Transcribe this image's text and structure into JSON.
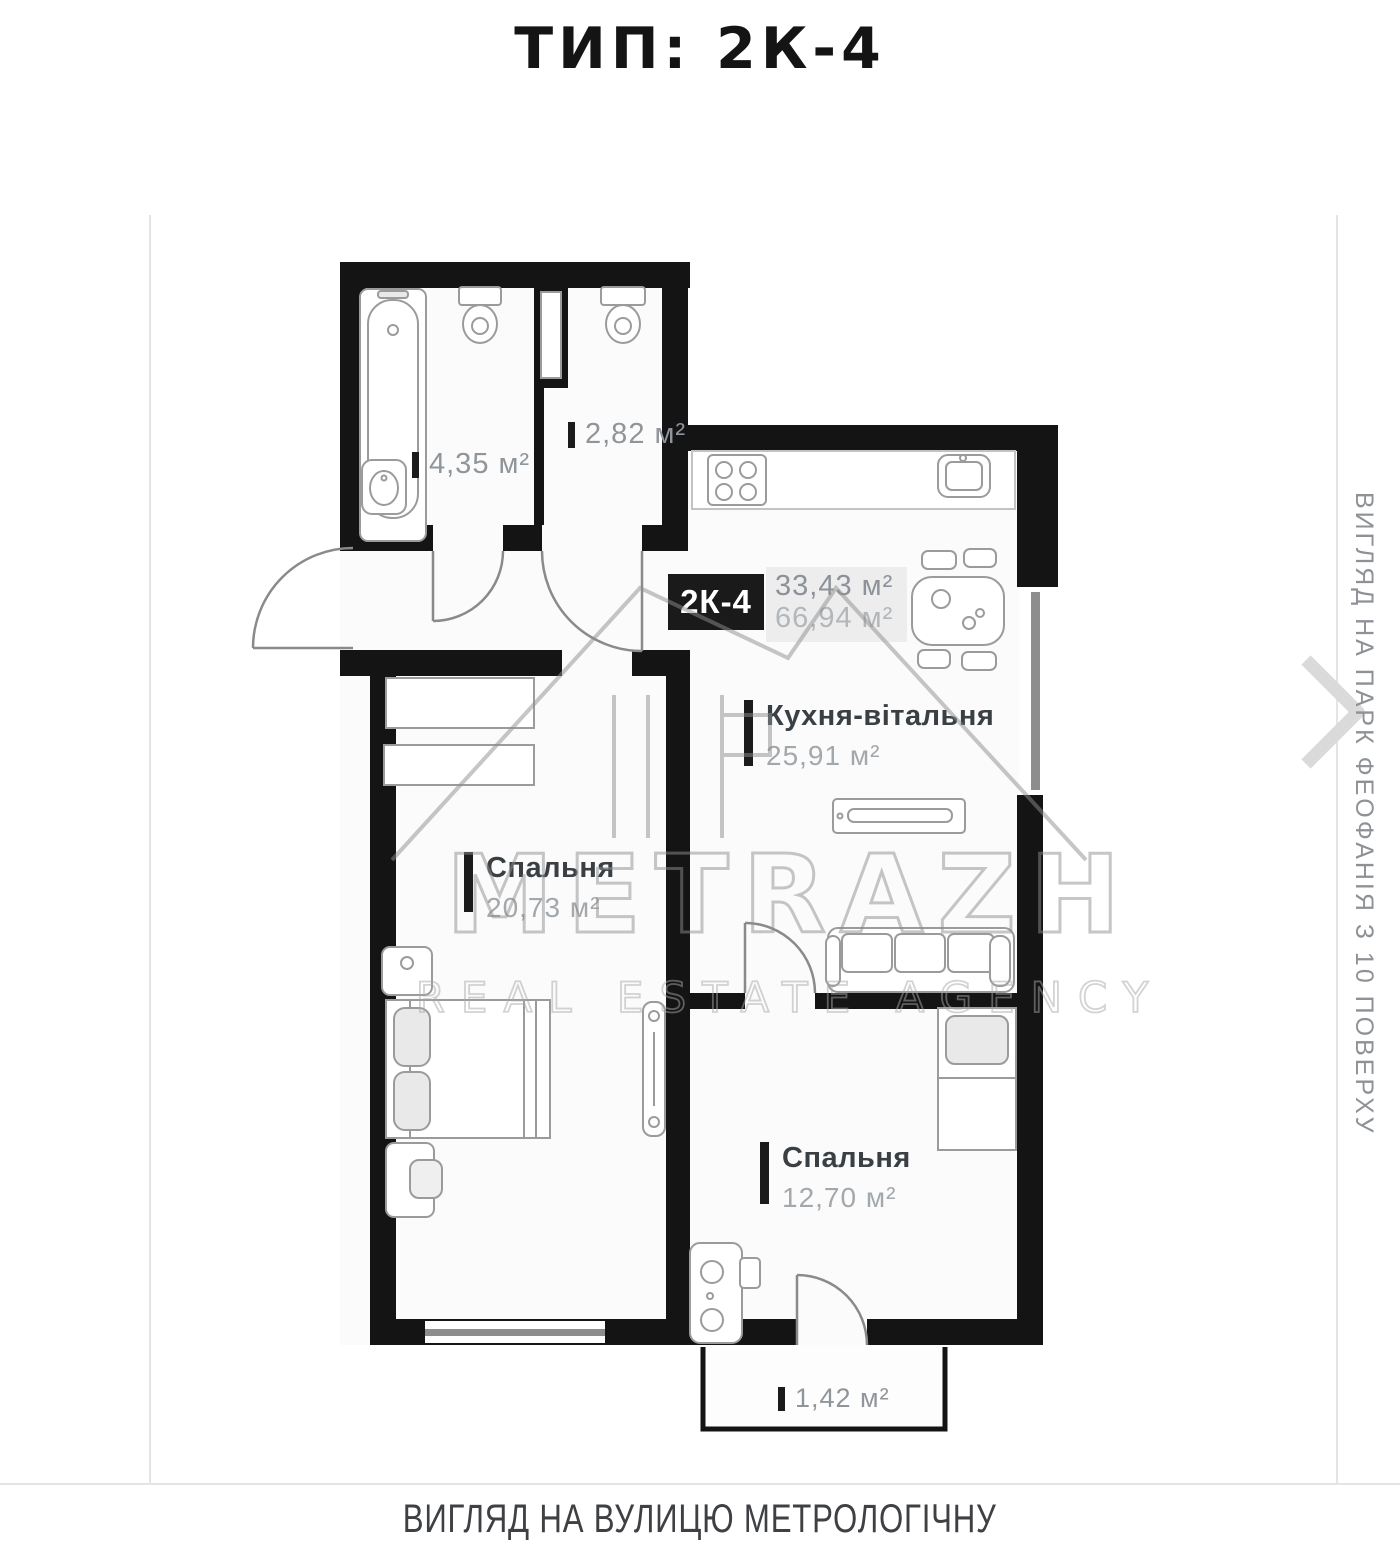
{
  "page": {
    "title": "ТИП: 2К-4",
    "bottom_caption": "ВИГЛЯД НА ВУЛИЦЮ МЕТРОЛОГІЧНУ",
    "side_caption": "ВИГЛЯД НА ПАРК ФЕОФАНІЯ З 10 ПОВЕРХУ"
  },
  "unit": {
    "code": "2К-4",
    "living_area": "33,43 м²",
    "total_area": "66,94 м²"
  },
  "rooms": {
    "kitchen_living": {
      "name": "Кухня-вітальня",
      "area": "25,91 м²"
    },
    "bedroom_left": {
      "name": "Спальня",
      "area": "20,73 м²"
    },
    "bedroom_right": {
      "name": "Спальня",
      "area": "12,70 м²"
    },
    "bathroom": {
      "area": "4,35 м²"
    },
    "wc": {
      "area": "2,82 м²"
    },
    "balcony": {
      "area": "1,42 м²"
    }
  },
  "watermark": {
    "brand": "METRAZH",
    "tagline": "REAL ESTATE AGENCY"
  },
  "colors": {
    "wall": "#151515",
    "badge_bg": "#1a1a1a",
    "room_name_text": "#3a3f44",
    "area_text": "#a3a8ad",
    "watermark": "#979797",
    "window": "#8d8d8d"
  }
}
